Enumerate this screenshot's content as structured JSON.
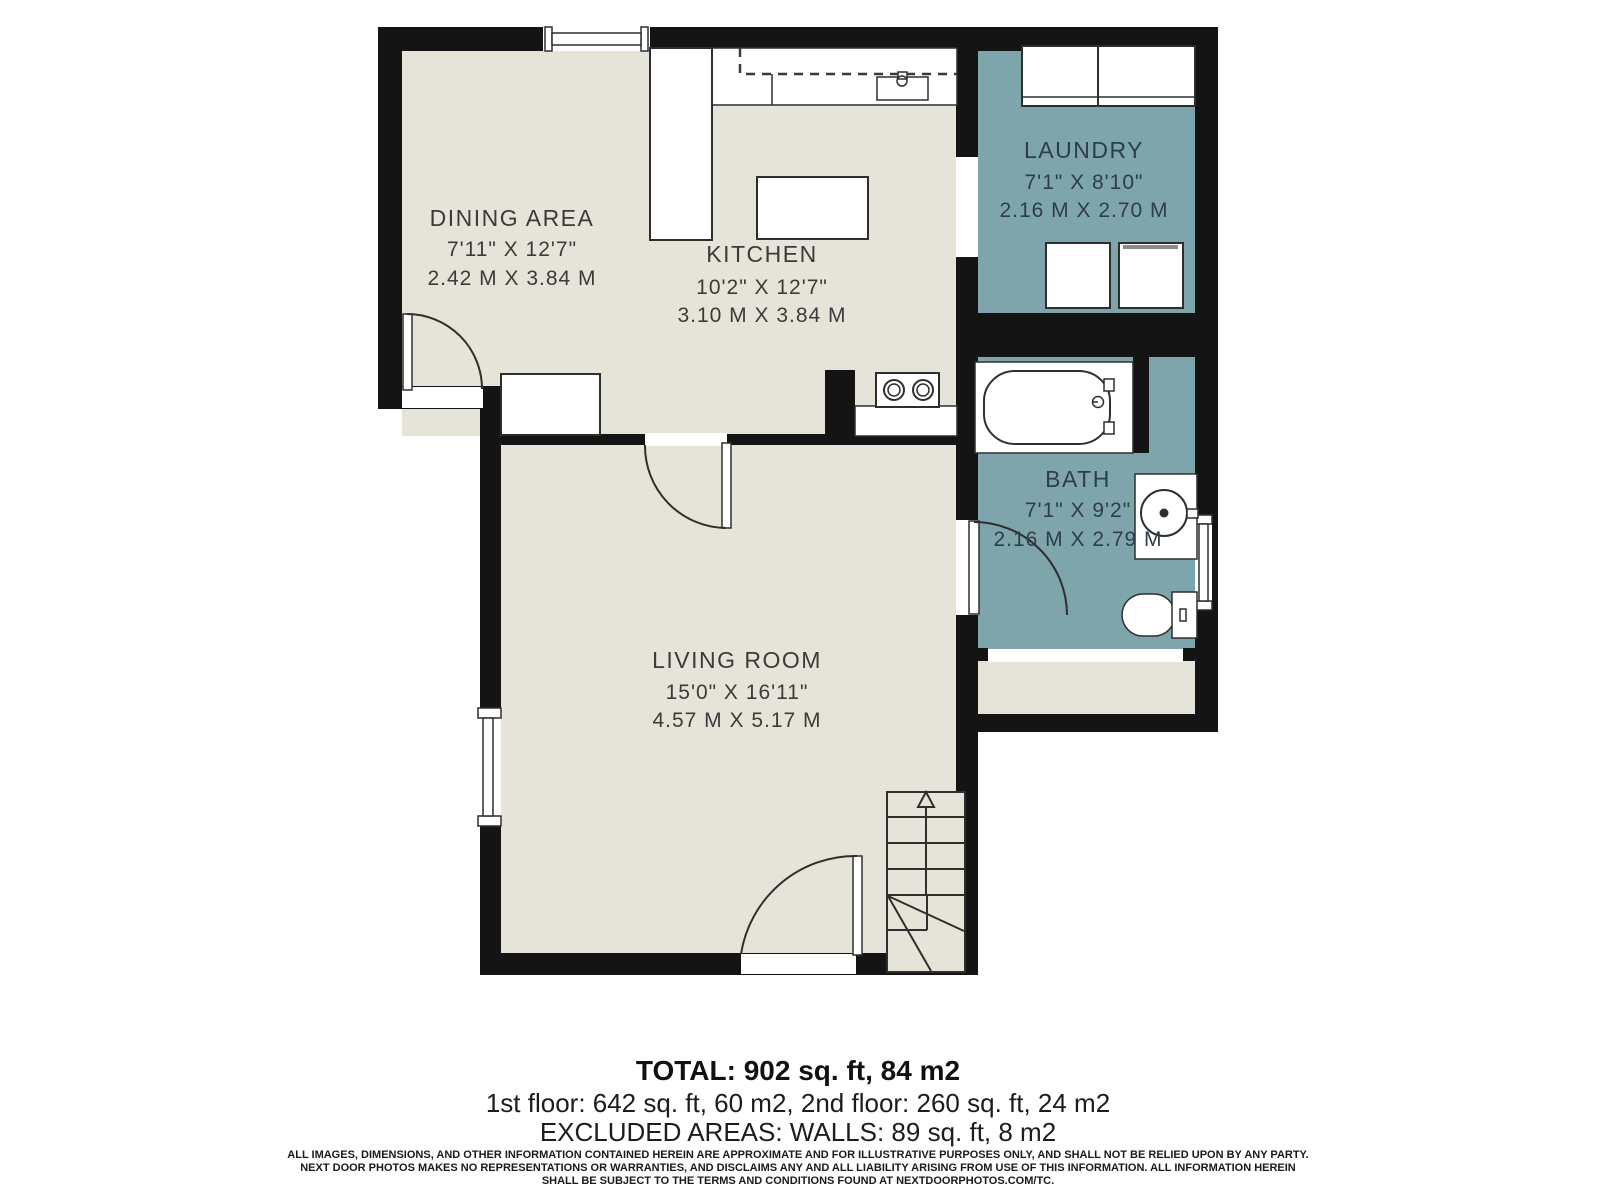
{
  "colors": {
    "wall": "#141414",
    "floor": "#E6E4D8",
    "wet_room_floor": "#7EA5AC",
    "room_label": "#3B3B3B",
    "wet_room_label": "#2E3E48"
  },
  "rooms": {
    "dining": {
      "name": "DINING AREA",
      "dims_ft": "7'11\" X 12'7\"",
      "dims_m": "2.42 M X 3.84 M"
    },
    "kitchen": {
      "name": "KITCHEN",
      "dims_ft": "10'2\" X 12'7\"",
      "dims_m": "3.10 M X 3.84 M"
    },
    "laundry": {
      "name": "LAUNDRY",
      "dims_ft": "7'1\" X 8'10\"",
      "dims_m": "2.16 M X 2.70 M"
    },
    "bath": {
      "name": "BATH",
      "dims_ft": "7'1\" X 9'2\"",
      "dims_m": "2.16 M X 2.79 M"
    },
    "living": {
      "name": "LIVING ROOM",
      "dims_ft": "15'0\" X 16'11\"",
      "dims_m": "4.57 M X 5.17 M"
    }
  },
  "summary": {
    "total": "TOTAL: 902 sq. ft, 84 m2",
    "floors": "1st floor: 642 sq. ft, 60 m2, 2nd floor: 260 sq. ft, 24 m2",
    "excluded": "EXCLUDED AREAS: WALLS: 89 sq. ft, 8 m2"
  },
  "disclaimer": {
    "line1": "ALL IMAGES, DIMENSIONS, AND OTHER INFORMATION CONTAINED HEREIN ARE APPROXIMATE AND FOR ILLUSTRATIVE PURPOSES ONLY, AND SHALL NOT BE RELIED UPON BY ANY PARTY.",
    "line2": "NEXT DOOR PHOTOS MAKES NO REPRESENTATIONS OR WARRANTIES, AND DISCLAIMS ANY AND ALL LIABILITY ARISING FROM USE OF THIS INFORMATION. ALL INFORMATION HEREIN",
    "line3": "SHALL BE SUBJECT TO THE TERMS AND CONDITIONS FOUND AT NEXTDOORPHOTOS.COM/TC."
  }
}
